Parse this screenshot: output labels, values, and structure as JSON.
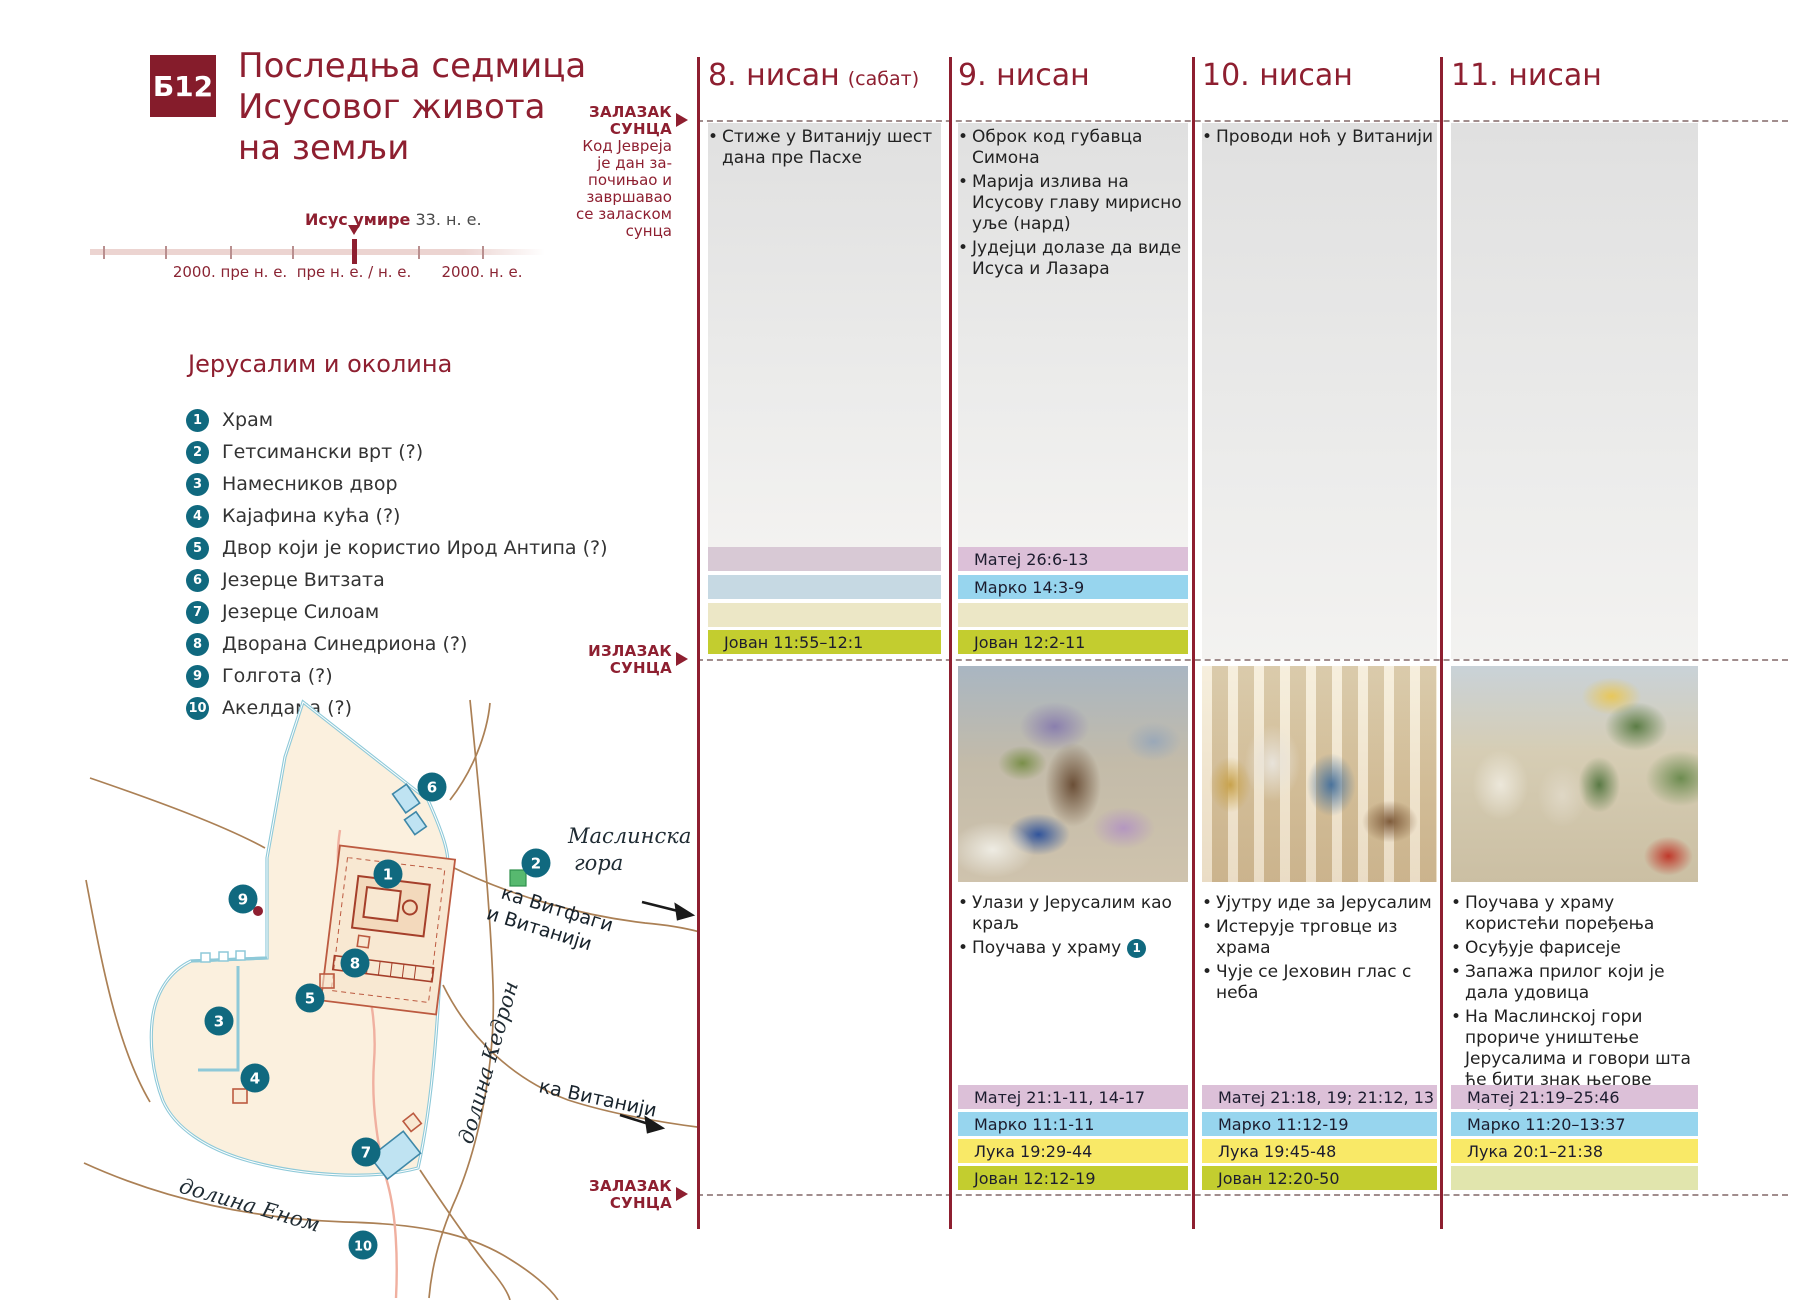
{
  "badge": "Б12",
  "title_lines": [
    "Последња седмица",
    "Исусовог живота",
    "на земљи"
  ],
  "timeline": {
    "caption_bold": "Исус умире",
    "caption_rest": " 33. н. е.",
    "tick_labels": [
      {
        "text": "2000. пре н. е.",
        "x": 230
      },
      {
        "text": "пре н. е. / н. е.",
        "x": 354
      },
      {
        "text": "2000. н. е.",
        "x": 482
      }
    ],
    "minor_ticks_x": [
      103,
      165,
      230,
      292,
      418,
      482
    ],
    "marker_x": 354
  },
  "legend": {
    "heading": "Јерусалим и околина",
    "items": [
      {
        "n": "1",
        "label": "Храм"
      },
      {
        "n": "2",
        "label": "Гетсимански врт (?)"
      },
      {
        "n": "3",
        "label": "Намесников двор"
      },
      {
        "n": "4",
        "label": "Кајафина кућа (?)"
      },
      {
        "n": "5",
        "label": "Двор који је користио Ирод Антипа (?)"
      },
      {
        "n": "6",
        "label": "Језерце Витзата"
      },
      {
        "n": "7",
        "label": "Језерце Силоам"
      },
      {
        "n": "8",
        "label": "Дворана Синедриона (?)"
      },
      {
        "n": "9",
        "label": "Голгота (?)"
      },
      {
        "n": "10",
        "label": "Акелдама (?)"
      }
    ]
  },
  "map": {
    "olive_mount_line1": "Маслинска",
    "olive_mount_line2": "гора",
    "to_bethphage_line1": "ка Витфаги",
    "to_bethphage_line2": "и Витанији",
    "to_bethany": "ка Витанији",
    "kidron_valley": "долина Кедрон",
    "hinnom_valley": "долина Еном",
    "markers": [
      {
        "n": "1",
        "x": 388,
        "y": 874
      },
      {
        "n": "2",
        "x": 536,
        "y": 863
      },
      {
        "n": "3",
        "x": 219,
        "y": 1021
      },
      {
        "n": "4",
        "x": 255,
        "y": 1078
      },
      {
        "n": "5",
        "x": 310,
        "y": 998
      },
      {
        "n": "6",
        "x": 432,
        "y": 787
      },
      {
        "n": "7",
        "x": 366,
        "y": 1152
      },
      {
        "n": "8",
        "x": 355,
        "y": 963
      },
      {
        "n": "9",
        "x": 243,
        "y": 899
      },
      {
        "n": "10",
        "x": 363,
        "y": 1245
      }
    ]
  },
  "margin": {
    "sunset_top": "ЗАЛАЗАК\nСУНЦА",
    "day_note": "Код Јевреја\nје дан за-\nпочињао и\nзавршавао\nсе заласком\nсунца",
    "sunrise": "ИЗЛАЗАК\nСУНЦА",
    "sunset_bottom": "ЗАЛАЗАК\nСУНЦА"
  },
  "bar_colors": {
    "matej": "#dcc0d8",
    "marko": "#97d5ee",
    "luka": "#f9e967",
    "jovan": "#c3cd2f",
    "matej_muted": "#d8c9d5",
    "marko_muted": "#c6d9e3",
    "luka_muted": "#ece7c6",
    "jovan_muted": "#e1e5ad"
  },
  "columns": [
    {
      "header": "8. нисан",
      "header_suffix": "(сабат)",
      "upper_events": [
        {
          "text": "Стиже у Витанију шест дана пре Пасхе"
        }
      ],
      "upper_refs": [
        {
          "book": "matej",
          "text": "",
          "muted": true
        },
        {
          "book": "marko",
          "text": "",
          "muted": true
        },
        {
          "book": "luka",
          "text": "",
          "muted": true
        },
        {
          "book": "jovan",
          "text": "Јован 11:55–12:1",
          "muted": false
        }
      ],
      "illustration": null,
      "lower_events": [],
      "lower_refs": []
    },
    {
      "header": "9. нисан",
      "header_suffix": "",
      "upper_events": [
        {
          "text": "Оброк код губавца Симона"
        },
        {
          "text": "Марија излива на Исусову главу мирисно уље (нард)"
        },
        {
          "text": "Јудејци долазе да виде Исуса и Лазара"
        }
      ],
      "upper_refs": [
        {
          "book": "matej",
          "text": "Матеј 26:6-13",
          "muted": false
        },
        {
          "book": "marko",
          "text": "Марко 14:3-9",
          "muted": false
        },
        {
          "book": "luka",
          "text": "",
          "muted": true
        },
        {
          "book": "jovan",
          "text": "Јован 12:2-11",
          "muted": false
        }
      ],
      "illustration": "entry",
      "lower_events": [
        {
          "text": "Улази у Јерусалим као краљ"
        },
        {
          "text": "Поучава у храму",
          "marker": "1"
        }
      ],
      "lower_refs": [
        {
          "book": "matej",
          "text": "Матеј 21:1-11, 14-17",
          "muted": false
        },
        {
          "book": "marko",
          "text": "Марко 11:1-11",
          "muted": false
        },
        {
          "book": "luka",
          "text": "Лука 19:29-44",
          "muted": false
        },
        {
          "book": "jovan",
          "text": "Јован 12:12-19",
          "muted": false
        }
      ]
    },
    {
      "header": "10. нисан",
      "header_suffix": "",
      "upper_events": [
        {
          "text": "Проводи ноћ у Витанији"
        }
      ],
      "upper_refs": [],
      "illustration": "temple",
      "lower_events": [
        {
          "text": "Ујутру иде за Јерусалим"
        },
        {
          "text": "Истерује трговце из храма"
        },
        {
          "text": "Чује се Јеховин глас с неба"
        }
      ],
      "lower_refs": [
        {
          "book": "matej",
          "text": "Матеј 21:18, 19; 21:12, 13",
          "muted": false
        },
        {
          "book": "marko",
          "text": "Марко 11:12-19",
          "muted": false
        },
        {
          "book": "luka",
          "text": "Лука 19:45-48",
          "muted": false
        },
        {
          "book": "jovan",
          "text": "Јован 12:20-50",
          "muted": false
        }
      ]
    },
    {
      "header": "11. нисан",
      "header_suffix": "",
      "upper_events": [],
      "upper_refs": [],
      "illustration": "teaching",
      "lower_events": [
        {
          "text": "Поучава у храму користећи поређења"
        },
        {
          "text": "Осуђује фарисеје"
        },
        {
          "text": "Запажа прилог који је дала удовица"
        },
        {
          "text": "На Маслинској гори прориче уништење Јерусалима и говори шта ће бити знак његове присутности"
        }
      ],
      "lower_refs": [
        {
          "book": "matej",
          "text": "Матеј 21:19–25:46",
          "muted": false
        },
        {
          "book": "marko",
          "text": "Марко 11:20–13:37",
          "muted": false
        },
        {
          "book": "luka",
          "text": "Лука 20:1–21:38",
          "muted": false
        },
        {
          "book": "jovan",
          "text": "",
          "muted": true
        }
      ]
    }
  ]
}
